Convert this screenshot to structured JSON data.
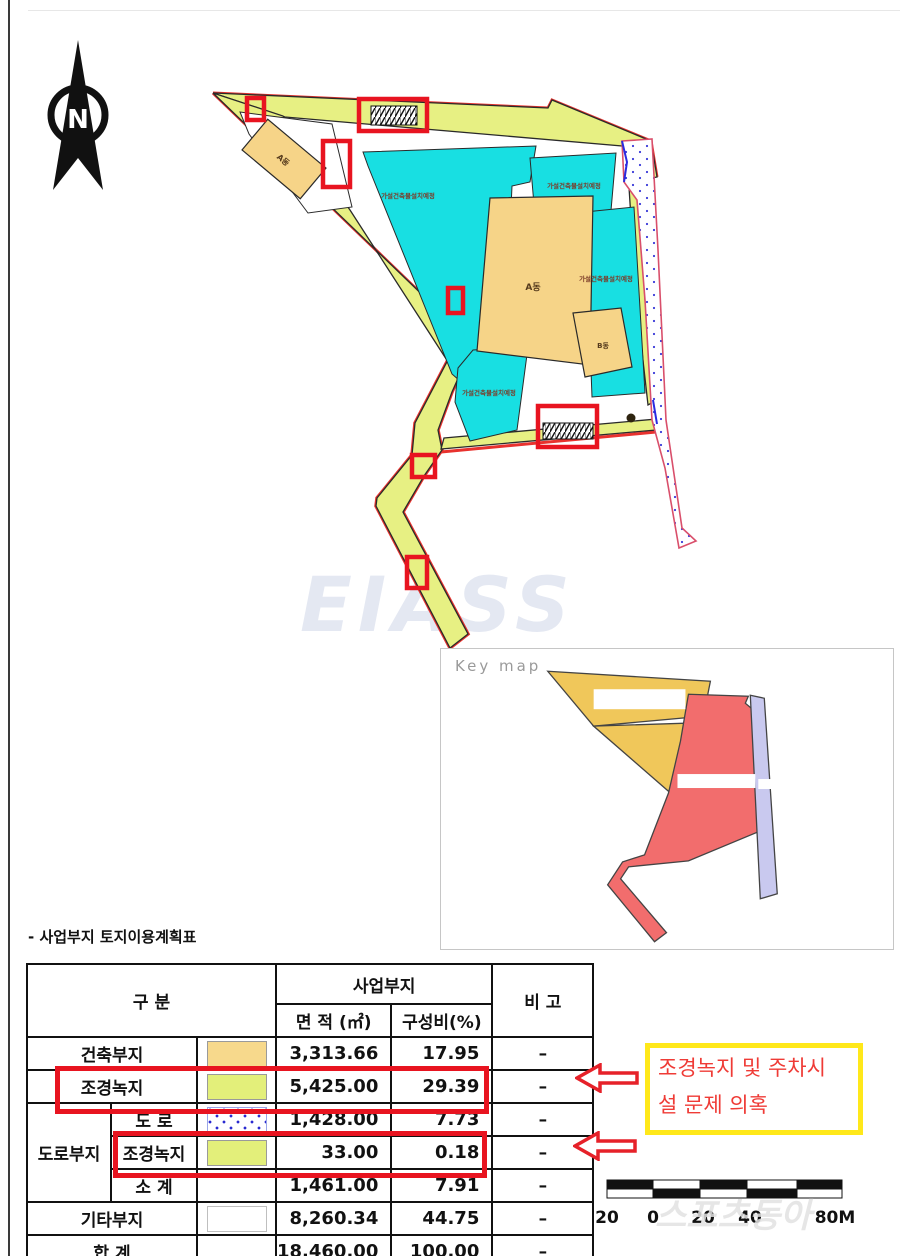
{
  "page": {
    "title_line": "- 사업부지 토지이용계획표"
  },
  "map": {
    "north_label": "N",
    "watermark": "EIASS",
    "area_label": "가설건축물설치예정",
    "building_a_small": "A동",
    "building_a_main": "A동",
    "building_b": "B동"
  },
  "keymap": {
    "label": "Key map"
  },
  "annotation": {
    "line1": "조경녹지 및 주차시",
    "line2": "설 문제 의혹"
  },
  "scalebar": {
    "labels": [
      "20",
      "0",
      "20",
      "40",
      "80M"
    ],
    "watermark": "스포츠동아"
  },
  "table": {
    "headers": {
      "gubun": "구 분",
      "site": "사업부지",
      "area": "면 적 (㎡)",
      "ratio": "구성비(%)",
      "note": "비 고"
    },
    "rows": [
      {
        "label": "건축부지",
        "swatch": "tan",
        "area": "3,313.66",
        "ratio": "17.95",
        "note": "–"
      },
      {
        "label": "조경녹지",
        "swatch": "green",
        "area": "5,425.00",
        "ratio": "29.39",
        "note": "–",
        "highlighted": true
      },
      {
        "group": "도로부지",
        "label": "도  로",
        "swatch": "dots",
        "area": "1,428.00",
        "ratio": "7.73",
        "note": "–"
      },
      {
        "label": "조경녹지",
        "swatch": "green",
        "area": "33.00",
        "ratio": "0.18",
        "note": "–",
        "highlighted": true
      },
      {
        "label": "소  계",
        "swatch": "none",
        "area": "1,461.00",
        "ratio": "7.91",
        "note": "–"
      },
      {
        "label": "기타부지",
        "swatch": "white",
        "area": "8,260.34",
        "ratio": "44.75",
        "note": "–"
      },
      {
        "label": "합 계",
        "swatch": "none",
        "area": "18,460.00",
        "ratio": "100.00",
        "note": "–"
      }
    ]
  },
  "colors": {
    "landscaping_green": "#e7f083",
    "temp_building_cyan": "#18dfe2",
    "building_tan": "#f6d488",
    "site_boundary_red": "#e8322e",
    "highlight_red": "#e81420",
    "annotation_yellow": "#ffe81a",
    "annotation_text_red": "#ef3b36",
    "road_dot_blue": "#2a2ad0"
  }
}
